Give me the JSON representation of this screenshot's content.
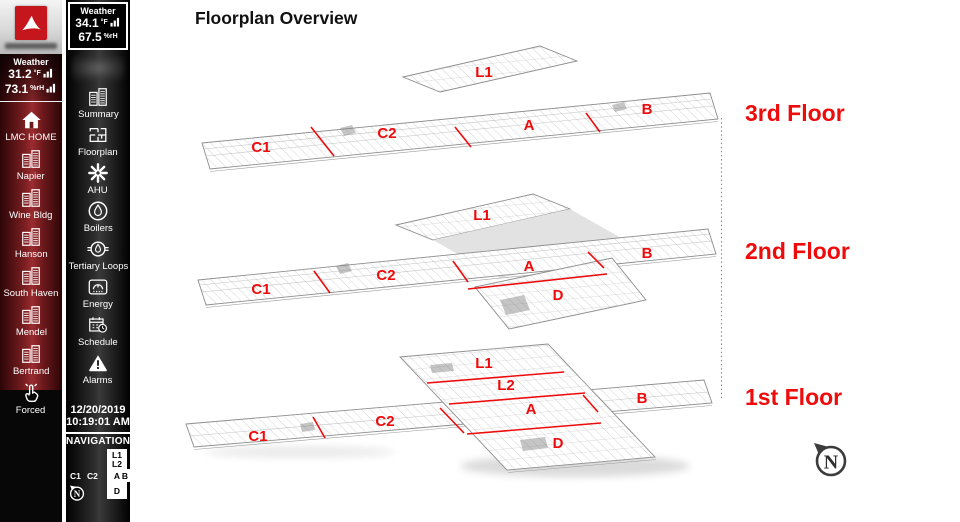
{
  "colors": {
    "accent_red": "#ee0b0b",
    "sidebar_maroon": "#9a2c30",
    "sidebar_black": "#000000",
    "plan_line": "#8c8c8c",
    "overlay_gray": "#e2e2e2"
  },
  "campus_sidebar": {
    "weather": {
      "title": "Weather",
      "temperature": "31.2",
      "temperature_unit": "°F",
      "humidity": "73.1",
      "humidity_unit": "%rH"
    },
    "items": [
      {
        "label": "LMC HOME",
        "icon": "home-icon"
      },
      {
        "label": "Napier",
        "icon": "buildings-icon"
      },
      {
        "label": "Wine Bldg",
        "icon": "buildings-icon"
      },
      {
        "label": "Hanson",
        "icon": "buildings-icon"
      },
      {
        "label": "South Haven",
        "icon": "buildings-icon"
      },
      {
        "label": "Mendel",
        "icon": "buildings-icon"
      },
      {
        "label": "Bertrand",
        "icon": "buildings-icon"
      },
      {
        "label": "Forced",
        "icon": "touch-icon"
      }
    ]
  },
  "building_sidebar": {
    "weather": {
      "title": "Weather",
      "temperature": "34.1",
      "temperature_unit": "°F",
      "humidity": "67.5",
      "humidity_unit": "%rH"
    },
    "items": [
      {
        "label": "Summary",
        "icon": "buildings-icon"
      },
      {
        "label": "Floorplan",
        "icon": "floorplan-icon"
      },
      {
        "label": "AHU",
        "icon": "fan-icon"
      },
      {
        "label": "Boilers",
        "icon": "flame-icon"
      },
      {
        "label": "Tertiary Loops",
        "icon": "loops-icon"
      },
      {
        "label": "Energy",
        "icon": "meter-icon"
      },
      {
        "label": "Schedule",
        "icon": "calendar-clock-icon"
      },
      {
        "label": "Alarms",
        "icon": "warning-icon"
      }
    ],
    "datetime": {
      "date": "12/20/2019",
      "time": "10:19:01 AM"
    },
    "navigation": {
      "title": "NAVIGATION",
      "l1": "L1",
      "l2": "L2",
      "c1": "C1",
      "c2": "C2",
      "a": "A",
      "b": "B",
      "d": "D",
      "compass": "N"
    }
  },
  "main": {
    "title": "Floorplan Overview",
    "compass": "N",
    "floors": [
      {
        "name": "3rd Floor",
        "sections": {
          "l1": "L1",
          "c1": "C1",
          "c2": "C2",
          "a": "A",
          "b": "B"
        }
      },
      {
        "name": "2nd Floor",
        "sections": {
          "l1": "L1",
          "c1": "C1",
          "c2": "C2",
          "a": "A",
          "b": "B",
          "d": "D"
        }
      },
      {
        "name": "1st Floor",
        "sections": {
          "l1": "L1",
          "l2": "L2",
          "c1": "C1",
          "c2": "C2",
          "a": "A",
          "b": "B",
          "d": "D"
        }
      }
    ]
  }
}
